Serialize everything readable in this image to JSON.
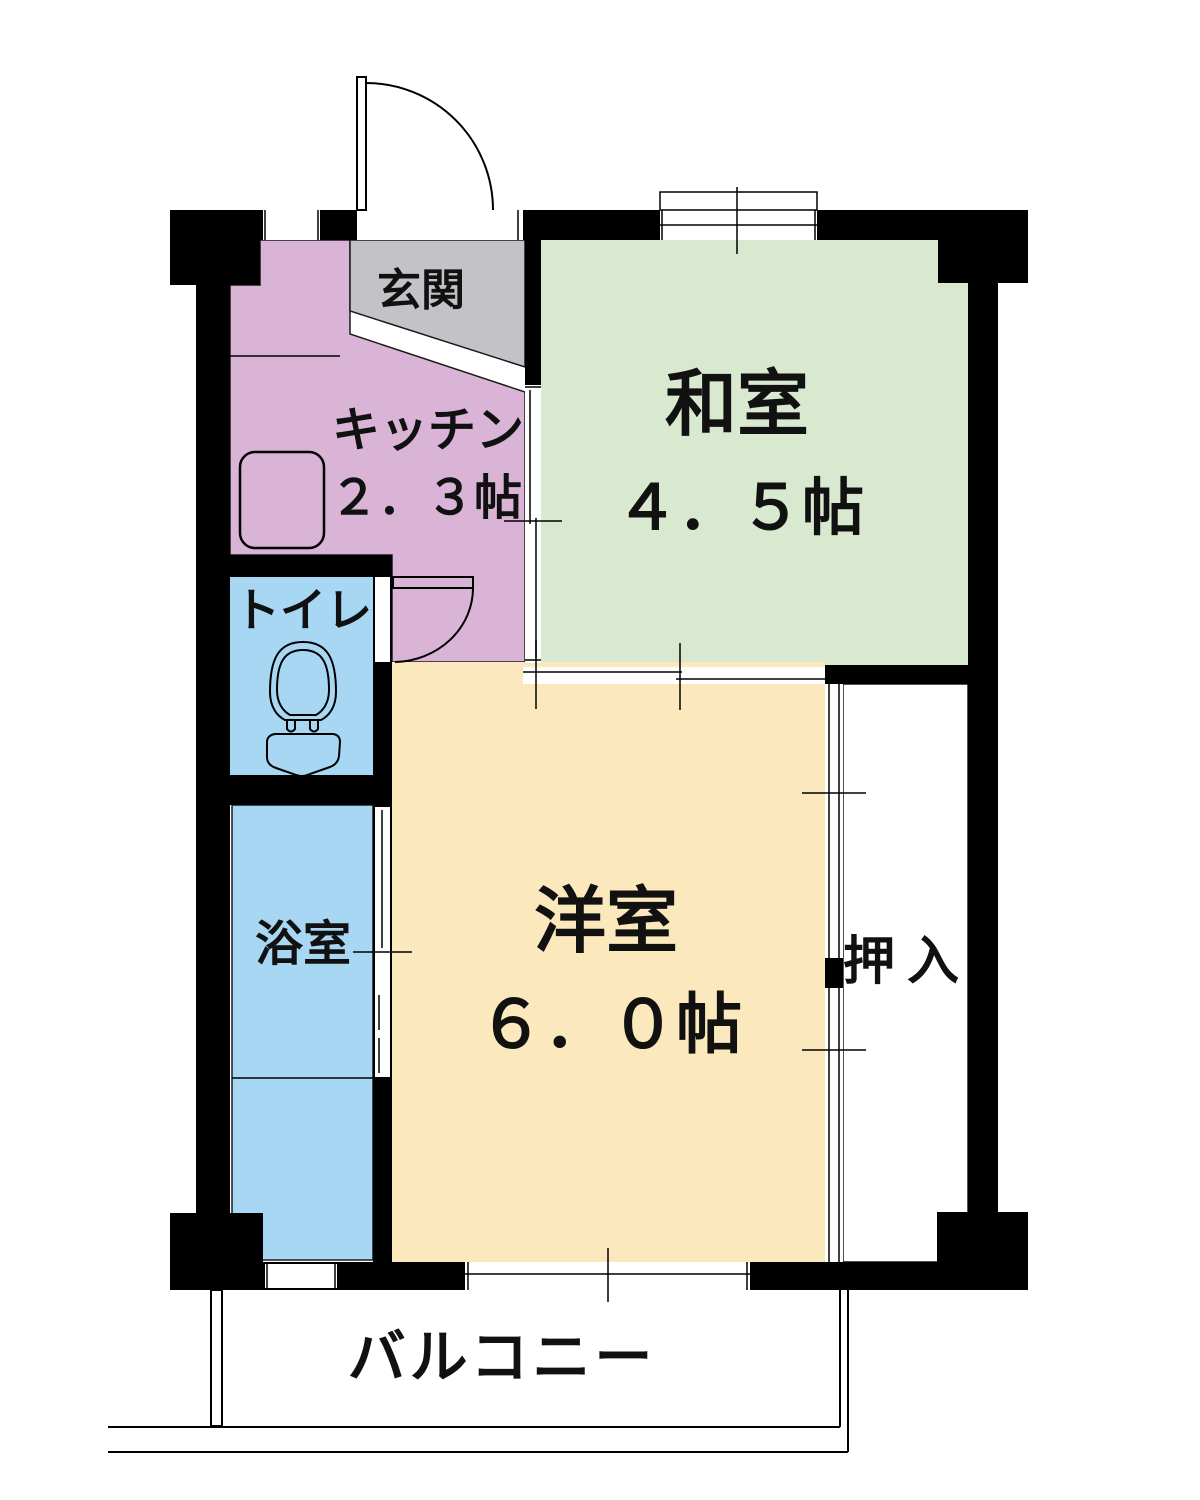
{
  "palette": {
    "wall": "#000000",
    "line": "#000000"
  },
  "rooms": {
    "genkan": {
      "label": "玄関",
      "color": "#c3c2c7"
    },
    "kitchen": {
      "label": "キッチン",
      "size": "２．３帖",
      "color": "#d9b4d6"
    },
    "washitsu": {
      "label": "和室",
      "size": "４．５帖",
      "color": "#d8e9d0"
    },
    "toilet": {
      "label": "トイレ",
      "color": "#a7d7f3"
    },
    "bath": {
      "label": "浴室",
      "color": "#a7d7f3"
    },
    "yoshitsu": {
      "label": "洋室",
      "size": "６．０帖",
      "color": "#fbe8bd"
    },
    "oshiire": {
      "label": "押入",
      "color": "#ffffff"
    },
    "balcony": {
      "label": "バルコニー"
    }
  },
  "icons": {
    "toilet": "toilet-top-view-icon",
    "sink": "kitchen-counter-icon",
    "entrance_door": "door-swing-icon",
    "inner_door": "door-swing-icon"
  }
}
